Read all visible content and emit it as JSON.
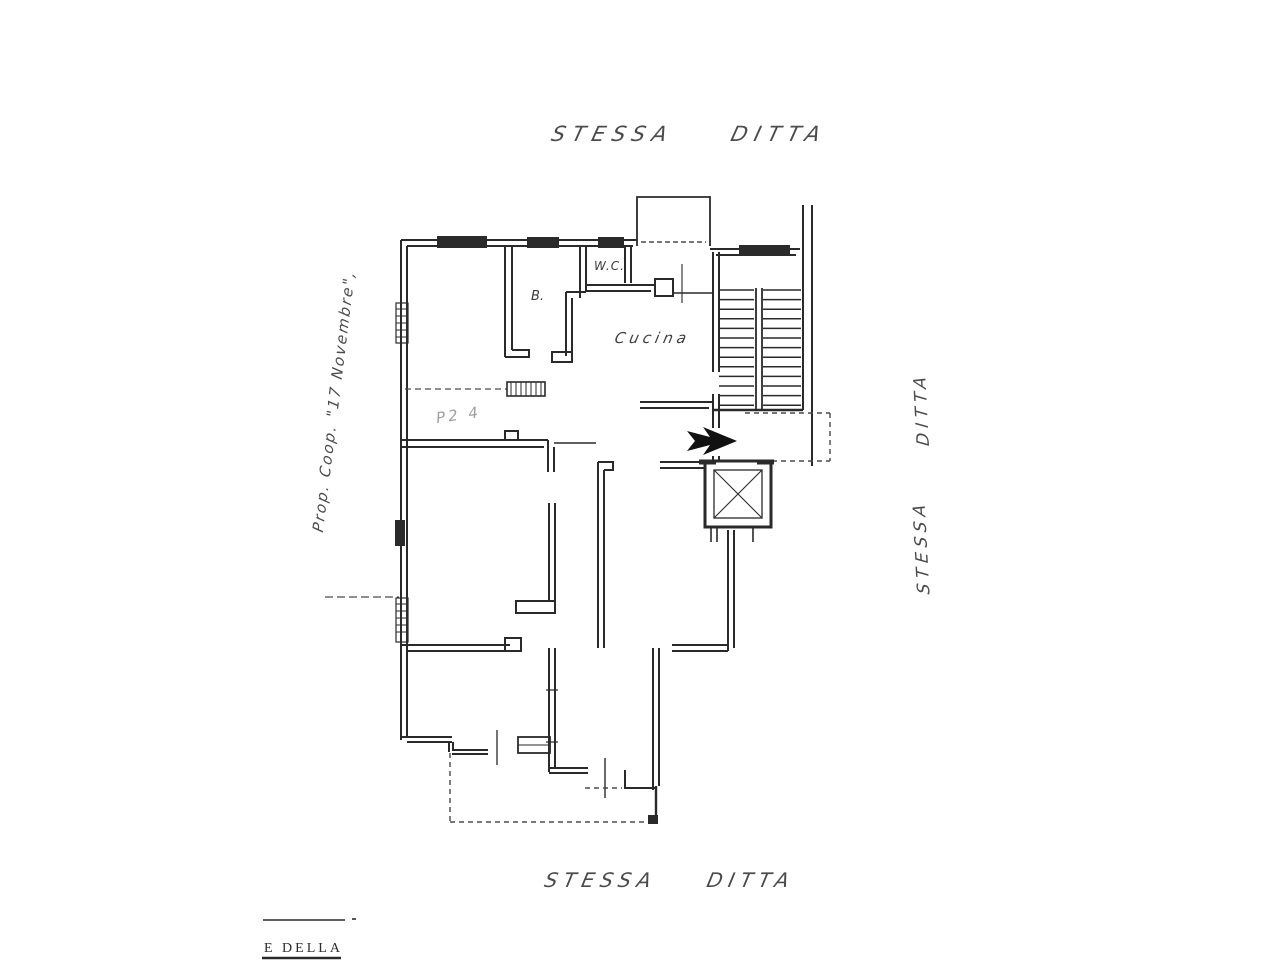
{
  "document": {
    "type": "floor-plan-scan",
    "paper": "#ffffff",
    "ink": "#2a2a2a",
    "faint_ink": "#9f9f9f"
  },
  "annotations": {
    "top_label": "STESSA DITTA",
    "bottom_label": "STESSA DITTA",
    "right_label_upper": "DITTA",
    "right_label_lower": "STESSA",
    "left_label": "Prop. Coop. \"17 Novembre\",",
    "pencil_note": "P2 4",
    "stamp_caption": "E DELLA"
  },
  "rooms": {
    "wc_label": "W.C.",
    "bath_label": "B.",
    "kitchen_label": "Cucina"
  },
  "stairs": {
    "tread_count": 13
  }
}
